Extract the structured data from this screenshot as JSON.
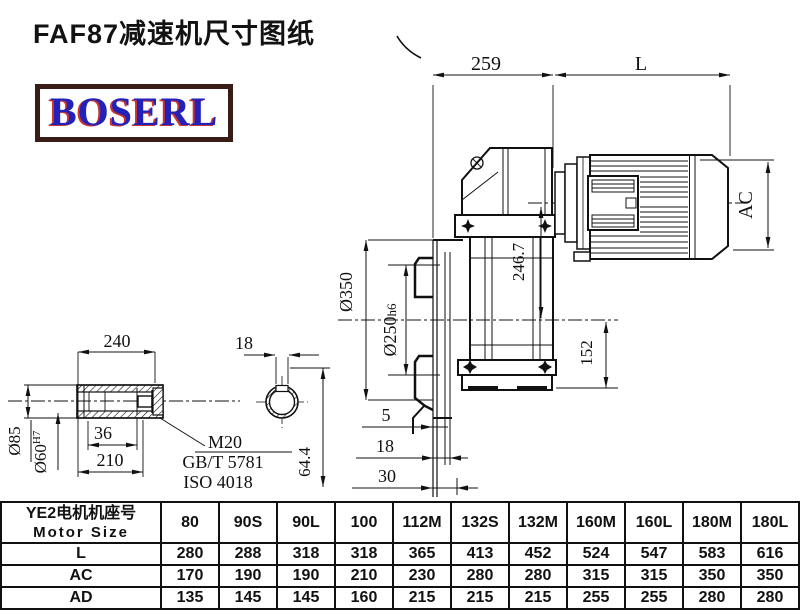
{
  "title": "FAF87减速机尺寸图纸",
  "logo": {
    "text": "BOSERL",
    "text_color": "#2222bb",
    "border_color": "#3a1c16"
  },
  "drawing": {
    "top_dims": {
      "d259": "259",
      "L": "L"
    },
    "right_dims": {
      "AC": "AC",
      "d152": "152"
    },
    "main_dims": {
      "d246_7": "246.7",
      "d350": "Ø350",
      "d250": "Ø250",
      "d250_suffix": "h6"
    },
    "bottom_dims": {
      "d5": "5",
      "d18": "18",
      "d30": "30"
    },
    "shaft_detail": {
      "d240": "240",
      "d36": "36",
      "d210": "210",
      "d85": "Ø85",
      "d60": "Ø60",
      "d60_sup": "H7",
      "thread": "M20",
      "standard1": "GB/T 5781",
      "standard2": "ISO 4018"
    },
    "section_detail": {
      "d18": "18",
      "d64_4": "64.4"
    }
  },
  "table": {
    "header_cn": "YE2电机机座号",
    "header_en": "Motor Size",
    "columns": [
      "80",
      "90S",
      "90L",
      "100",
      "112M",
      "132S",
      "132M",
      "160M",
      "160L",
      "180M",
      "180L"
    ],
    "rows": [
      {
        "label": "L",
        "values": [
          "280",
          "288",
          "318",
          "318",
          "365",
          "413",
          "452",
          "524",
          "547",
          "583",
          "616"
        ]
      },
      {
        "label": "AC",
        "values": [
          "170",
          "190",
          "190",
          "210",
          "230",
          "280",
          "280",
          "315",
          "315",
          "350",
          "350"
        ]
      },
      {
        "label": "AD",
        "values": [
          "135",
          "145",
          "145",
          "160",
          "215",
          "215",
          "215",
          "255",
          "255",
          "280",
          "280"
        ]
      }
    ]
  }
}
